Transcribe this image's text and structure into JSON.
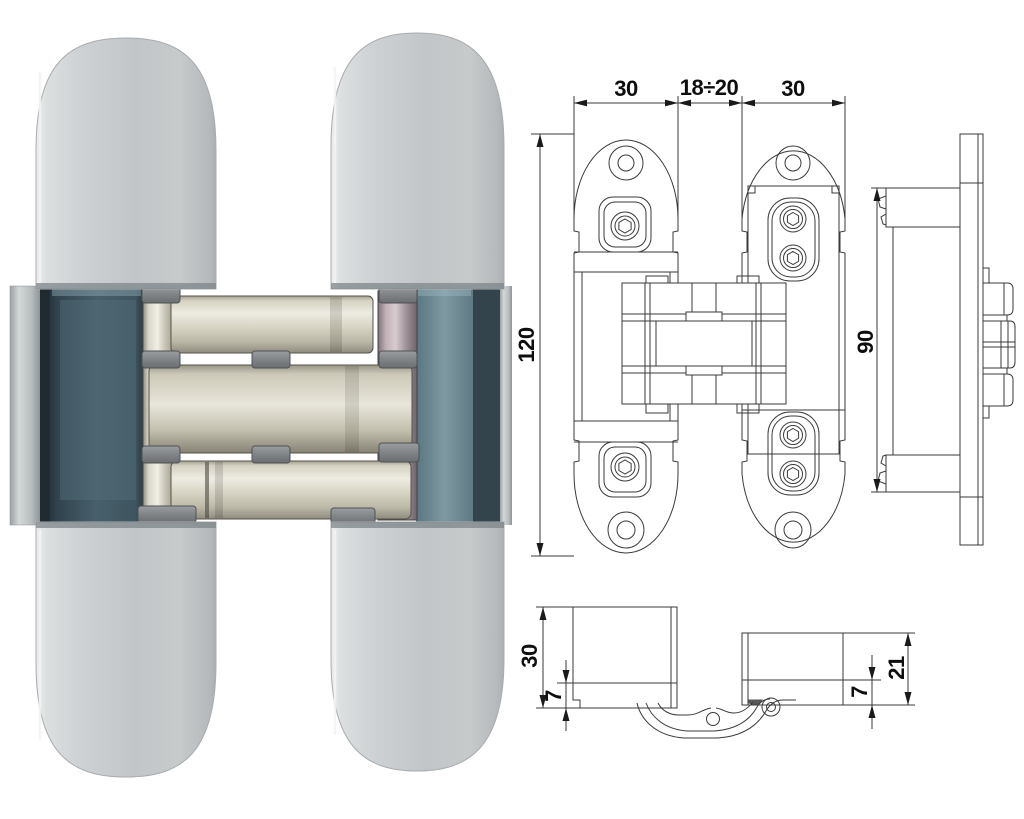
{
  "figure": {
    "type": "product-photo-with-technical-drawing",
    "subject": "Concealed invisible door hinge (photo left, dimensioned drawings right)"
  },
  "labels": {
    "front_top_left_width": "30",
    "front_top_gap": "18÷20",
    "front_top_right_width": "30",
    "front_height": "120",
    "side_height": "90",
    "section_left_depth": "30",
    "section_left_inset": "7",
    "section_right_inset": "7",
    "section_right_depth": "21"
  },
  "colors": {
    "background": "#ffffff",
    "drawing_line": "#3a3a3a",
    "label_text": "#0e0e0e",
    "cover_silver": "#c7cbcd",
    "channel_teal_dark": "#3c4f58",
    "channel_teal_light": "#7b929c",
    "zinc_link": "#cdc7b5",
    "zinc_link_purple": "#b3a2a9",
    "pivot_gray": "#84878a"
  }
}
